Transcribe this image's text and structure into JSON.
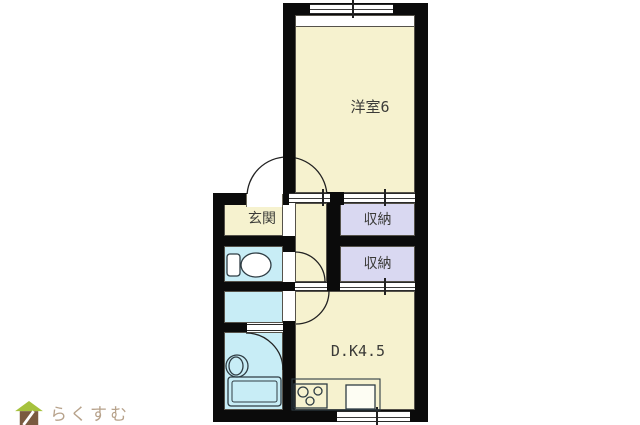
{
  "plan_title": "1DK floor plan",
  "rooms": {
    "western": {
      "label": "洋室6"
    },
    "entrance": {
      "label": "玄関"
    },
    "storage_upper": {
      "label": "収納"
    },
    "storage_lower": {
      "label": "収納"
    },
    "dining_kitchen": {
      "label": "D.K4.5"
    },
    "toilet": {
      "label": ""
    },
    "washroom": {
      "label": ""
    },
    "bathroom": {
      "label": ""
    },
    "hallway": {
      "label": ""
    }
  },
  "fixtures": {
    "toilet": "toilet-icon",
    "bathtub": "bathtub-icon",
    "washbasin": "washbasin-icon",
    "stove": "stove-3-burner-icon",
    "kitchen_sink": "kitchen-sink-icon",
    "counter": "kitchen-counter",
    "windows": "sliding-window-symbol",
    "doors": "door-swing-arc"
  },
  "watermark": {
    "brand": "らくすむ",
    "icon": "house-icon"
  },
  "colors": {
    "canvas_white": "#ffffff",
    "room_cream": "#f6f2cf",
    "closet_lavender": "#d9d8f1",
    "wet_cyan": "#c8edf6",
    "wall_black": "#0b0b0b",
    "line_dark": "#55524a",
    "fixture_line": "#2f3d44",
    "label_text": "#3b3b38",
    "logo_text": "#b7a28b",
    "logo_roof": "#a6c23d",
    "logo_body": "#7a5a40"
  }
}
